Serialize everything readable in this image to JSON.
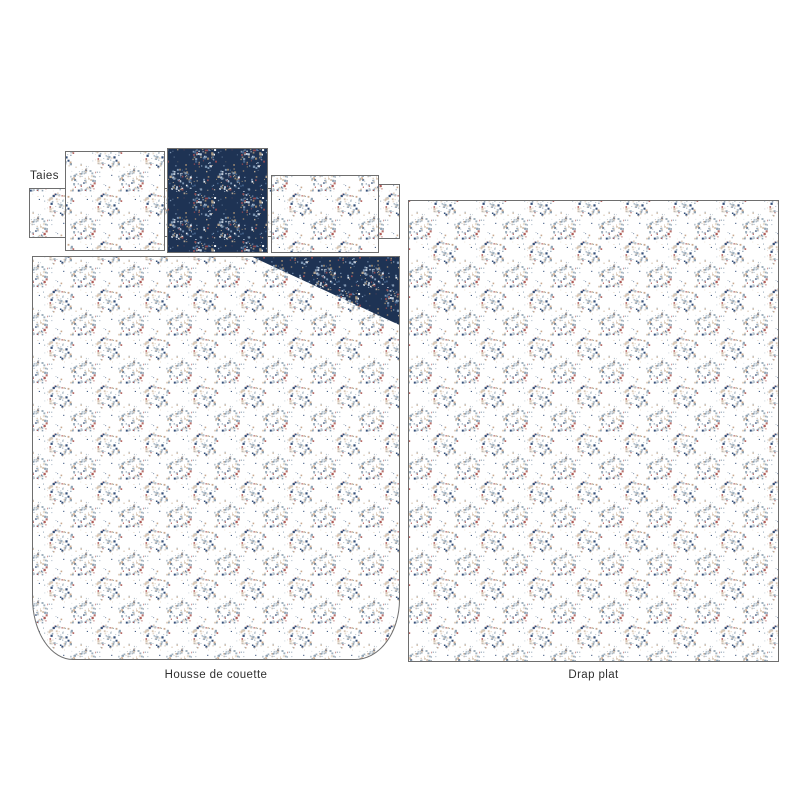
{
  "labels": {
    "pillowcases": "Taies",
    "duvet_cover": "Housse de couette",
    "flat_sheet": "Drap plat"
  },
  "fabrics": {
    "floral_white": {
      "name": "floral-white-ditsy",
      "background": "#ffffff",
      "dot_colors": [
        "#8fa3b5",
        "#b9c5cf",
        "#d9c7b4",
        "#e8ddd0",
        "#9fb0be",
        "#35507a",
        "#b05a58",
        "#c9a98f"
      ],
      "dot_weights": [
        0.22,
        0.16,
        0.18,
        0.1,
        0.12,
        0.08,
        0.08,
        0.06
      ]
    },
    "floral_navy": {
      "name": "floral-navy-ditsy",
      "background": "#1e3354",
      "dot_colors": [
        "#7e97b4",
        "#c3cfdd",
        "#97856f",
        "#f0f3f6",
        "#46648c",
        "#8e4a52",
        "#b4a693"
      ],
      "dot_weights": [
        0.24,
        0.15,
        0.18,
        0.1,
        0.15,
        0.08,
        0.1
      ]
    }
  },
  "style": {
    "border_color": "#6e6e6e",
    "label_color": "#2f2f2f",
    "canvas_background": "#ffffff"
  }
}
